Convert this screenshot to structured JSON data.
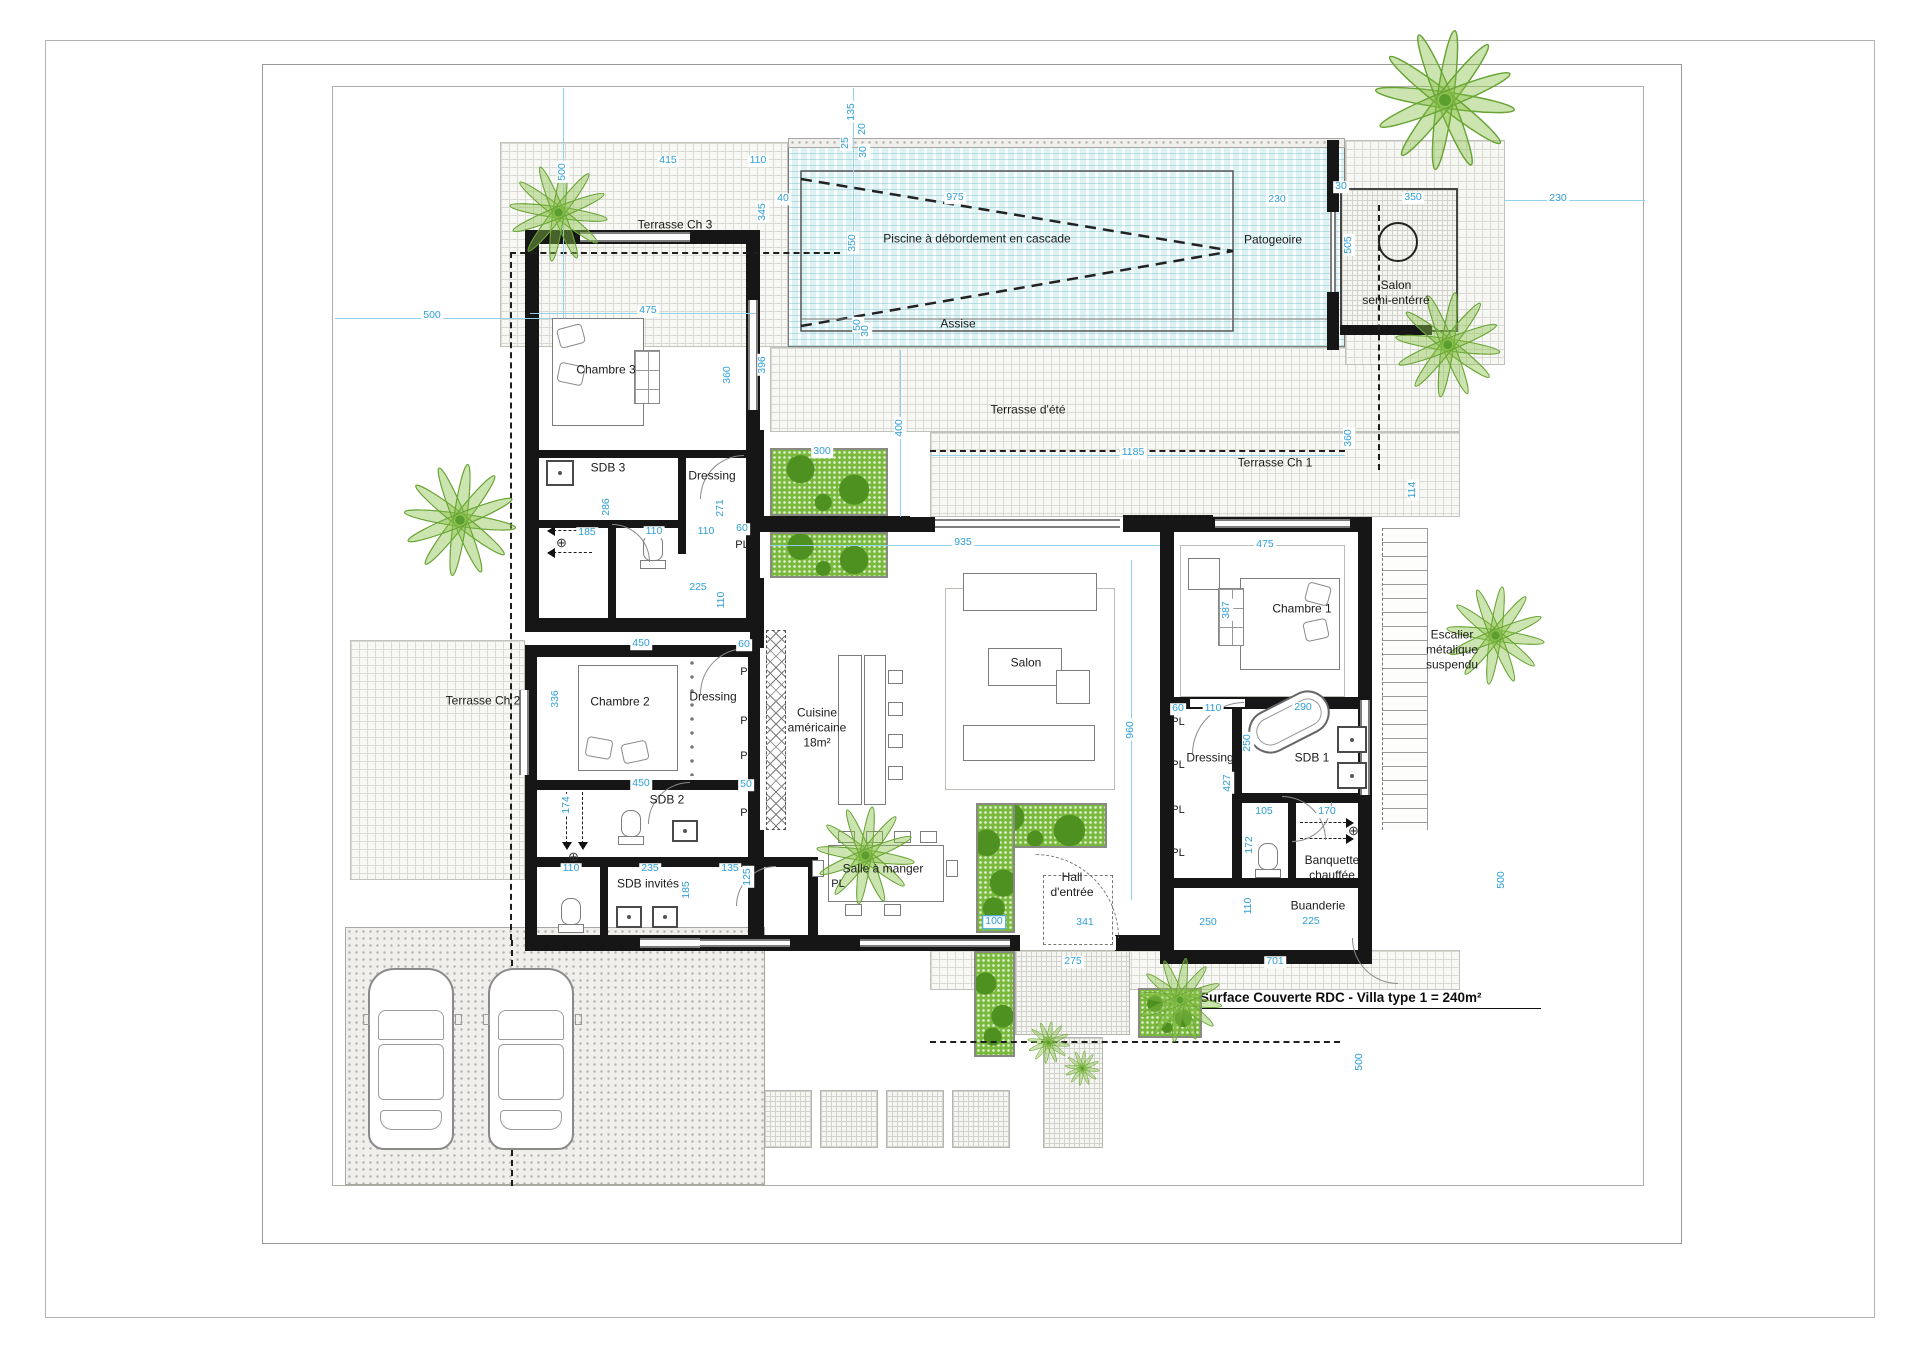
{
  "annotation": {
    "text": "Surface Couverte RDC  - Villa type 1 = 240m²"
  },
  "closet_label": "PL",
  "colors": {
    "dimension": "#2f9fd6",
    "wall": "#161616",
    "water": "#def1f3",
    "plant": "#79b93b"
  },
  "rooms": [
    {
      "id": "terrasse-ch3",
      "label": "Terrasse Ch 3",
      "x": 675,
      "y": 225
    },
    {
      "id": "chambre3",
      "label": "Chambre 3",
      "x": 606,
      "y": 370
    },
    {
      "id": "sdb3",
      "label": "SDB 3",
      "x": 608,
      "y": 468
    },
    {
      "id": "dressing3",
      "label": "Dressing",
      "x": 712,
      "y": 476
    },
    {
      "id": "piscine",
      "label": "Piscine à débordement en cascade",
      "x": 977,
      "y": 239
    },
    {
      "id": "patogeoire",
      "label": "Patogeoire",
      "x": 1273,
      "y": 240
    },
    {
      "id": "assise",
      "label": "Assise",
      "x": 958,
      "y": 324
    },
    {
      "id": "salon-semi-enterre",
      "label": "Salon\nsemi-entérré",
      "x": 1396,
      "y": 293
    },
    {
      "id": "terrasse-ete",
      "label": "Terrasse d'été",
      "x": 1028,
      "y": 410
    },
    {
      "id": "terrasse-ch1",
      "label": "Terrasse Ch 1",
      "x": 1275,
      "y": 463
    },
    {
      "id": "chambre1",
      "label": "Chambre 1",
      "x": 1302,
      "y": 609
    },
    {
      "id": "dressing1",
      "label": "Dressing",
      "x": 1210,
      "y": 758
    },
    {
      "id": "sdb1",
      "label": "SDB 1",
      "x": 1312,
      "y": 758
    },
    {
      "id": "banquette-chauffee",
      "label": "Banquette\nchauffée",
      "x": 1332,
      "y": 868
    },
    {
      "id": "buanderie",
      "label": "Buanderie",
      "x": 1318,
      "y": 906
    },
    {
      "id": "escalier",
      "label": "Escalier\nmétalique\nsuspendu",
      "x": 1452,
      "y": 650
    },
    {
      "id": "terrasse-ch2",
      "label": "Terrasse Ch 2",
      "x": 483,
      "y": 701
    },
    {
      "id": "chambre2",
      "label": "Chambre 2",
      "x": 620,
      "y": 702
    },
    {
      "id": "dressing2",
      "label": "Dressing",
      "x": 713,
      "y": 697
    },
    {
      "id": "sdb2",
      "label": "SDB 2",
      "x": 667,
      "y": 800
    },
    {
      "id": "sdb-invites",
      "label": "SDB invités",
      "x": 648,
      "y": 884
    },
    {
      "id": "cuisine",
      "label": "Cuisine\naméricaine\n18m²",
      "x": 817,
      "y": 728
    },
    {
      "id": "salon",
      "label": "Salon",
      "x": 1026,
      "y": 663
    },
    {
      "id": "salle-a-manger",
      "label": "Salle à manger",
      "x": 883,
      "y": 869
    },
    {
      "id": "hall-entree",
      "label": "Hall\nd'entrée",
      "x": 1072,
      "y": 885
    }
  ],
  "pl_positions": [
    [
      742,
      545
    ],
    [
      747,
      672
    ],
    [
      747,
      721
    ],
    [
      747,
      756
    ],
    [
      747,
      813
    ],
    [
      838,
      884
    ],
    [
      1178,
      722
    ],
    [
      1178,
      765
    ],
    [
      1178,
      810
    ],
    [
      1178,
      853
    ]
  ],
  "dimensions": [
    [
      "135",
      852,
      112,
      1
    ],
    [
      "20",
      863,
      129,
      1
    ],
    [
      "25",
      846,
      143,
      1
    ],
    [
      "30",
      864,
      152,
      1
    ],
    [
      "415",
      668,
      161,
      0
    ],
    [
      "110",
      758,
      161,
      0
    ],
    [
      "345",
      763,
      212,
      1
    ],
    [
      "40",
      783,
      199,
      0
    ],
    [
      "975",
      955,
      198,
      0
    ],
    [
      "350",
      853,
      243,
      1
    ],
    [
      "50",
      858,
      325,
      1
    ],
    [
      "30",
      866,
      331,
      1
    ],
    [
      "230",
      1277,
      200,
      0
    ],
    [
      "30",
      1341,
      187,
      0
    ],
    [
      "350",
      1413,
      198,
      0
    ],
    [
      "230",
      1558,
      199,
      0
    ],
    [
      "505",
      1349,
      245,
      1
    ],
    [
      "500",
      563,
      172,
      1
    ],
    [
      "500",
      432,
      316,
      0
    ],
    [
      "396",
      763,
      365,
      1
    ],
    [
      "475",
      648,
      311,
      0
    ],
    [
      "360",
      728,
      375,
      1
    ],
    [
      "286",
      607,
      507,
      1
    ],
    [
      "271",
      721,
      508,
      1
    ],
    [
      "185",
      587,
      533,
      0
    ],
    [
      "110",
      654,
      532,
      0
    ],
    [
      "110",
      706,
      532,
      0
    ],
    [
      "60",
      742,
      529,
      0
    ],
    [
      "225",
      698,
      588,
      0
    ],
    [
      "110",
      722,
      600,
      1
    ],
    [
      "400",
      900,
      428,
      1
    ],
    [
      "1185",
      1133,
      453,
      0
    ],
    [
      "360",
      1349,
      438,
      1
    ],
    [
      "114",
      1413,
      490,
      1
    ],
    [
      "935",
      963,
      543,
      0
    ],
    [
      "475",
      1265,
      545,
      0
    ],
    [
      "387",
      1227,
      610,
      1
    ],
    [
      "960",
      1131,
      730,
      1
    ],
    [
      "60",
      1178,
      709,
      0
    ],
    [
      "110",
      1213,
      709,
      0
    ],
    [
      "290",
      1303,
      708,
      0
    ],
    [
      "250",
      1248,
      743,
      1
    ],
    [
      "427",
      1228,
      783,
      1
    ],
    [
      "105",
      1264,
      812,
      0
    ],
    [
      "170",
      1327,
      812,
      0
    ],
    [
      "172",
      1250,
      845,
      1
    ],
    [
      "450",
      641,
      644,
      0
    ],
    [
      "336",
      556,
      699,
      1
    ],
    [
      "450",
      641,
      784,
      0
    ],
    [
      "60",
      744,
      645,
      0
    ],
    [
      "50",
      746,
      785,
      0
    ],
    [
      "174",
      567,
      805,
      1
    ],
    [
      "110",
      571,
      869,
      0
    ],
    [
      "235",
      650,
      869,
      0
    ],
    [
      "135",
      730,
      869,
      0
    ],
    [
      "125",
      748,
      877,
      1
    ],
    [
      "185",
      687,
      890,
      1
    ],
    [
      "100",
      994,
      922,
      0
    ],
    [
      "341",
      1085,
      923,
      0
    ],
    [
      "250",
      1208,
      923,
      0
    ],
    [
      "110",
      1249,
      906,
      1
    ],
    [
      "225",
      1311,
      922,
      0
    ],
    [
      "275",
      1073,
      962,
      0
    ],
    [
      "701",
      1275,
      962,
      0
    ],
    [
      "500",
      1502,
      880,
      1
    ],
    [
      "500",
      1360,
      1062,
      1
    ],
    [
      "300",
      822,
      452,
      0
    ]
  ]
}
